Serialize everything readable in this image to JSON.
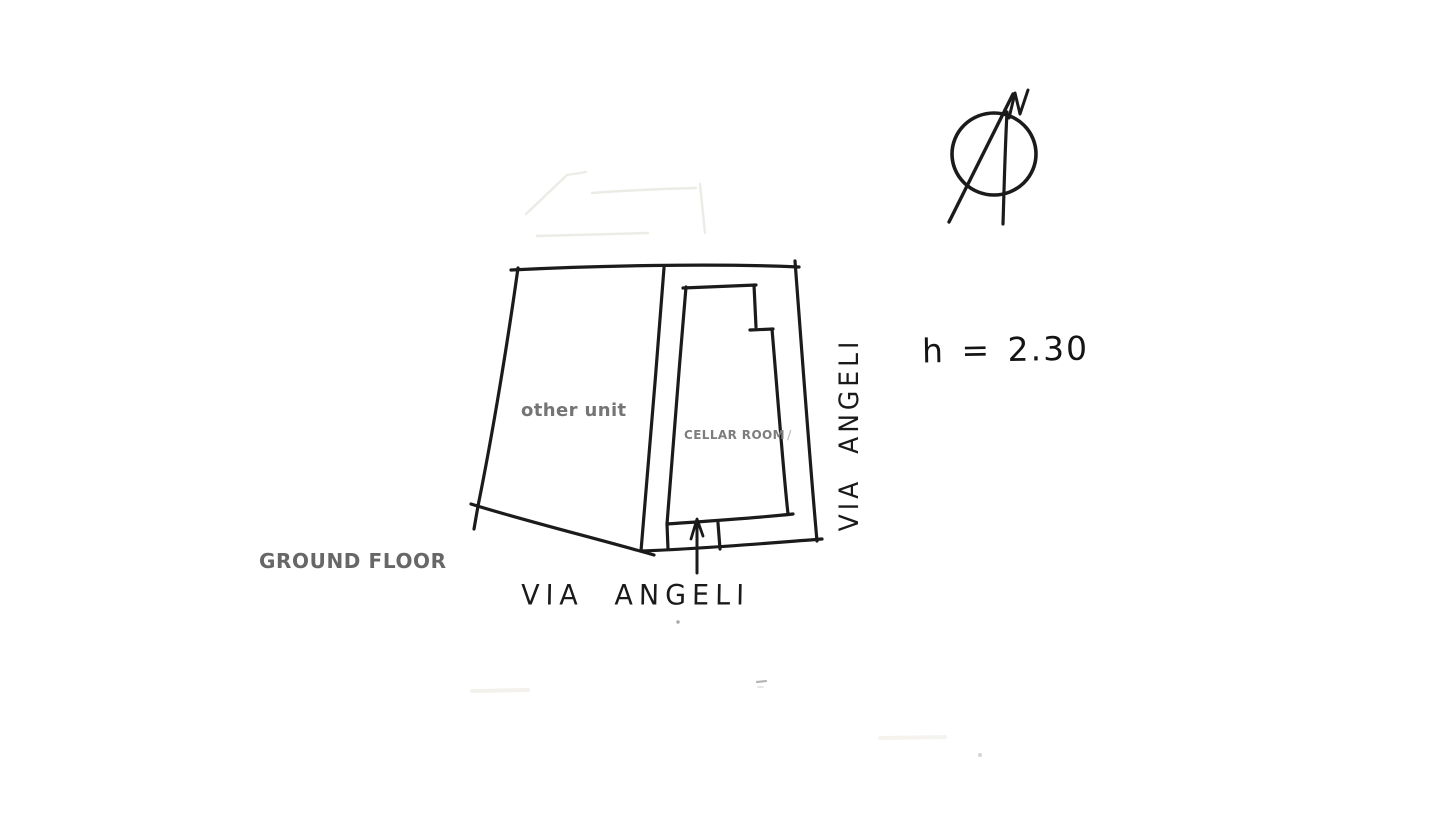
{
  "labels": {
    "other_unit": "other unit",
    "cellar_room": "CELLAR ROOM",
    "cellar_room_suffix": "/",
    "ground_floor": "GROUND FLOOR",
    "street_bottom": "VIA ANGELI",
    "street_right": "VIA ANGELI",
    "height_note": "h = 2.30",
    "compass_north": "N"
  },
  "colors": {
    "ink": "#1b1b1b",
    "unit_label_gray": "#757575",
    "cellar_label_gray": "#7d7d7d",
    "floor_label_gray": "#676767",
    "background": "#ffffff"
  }
}
